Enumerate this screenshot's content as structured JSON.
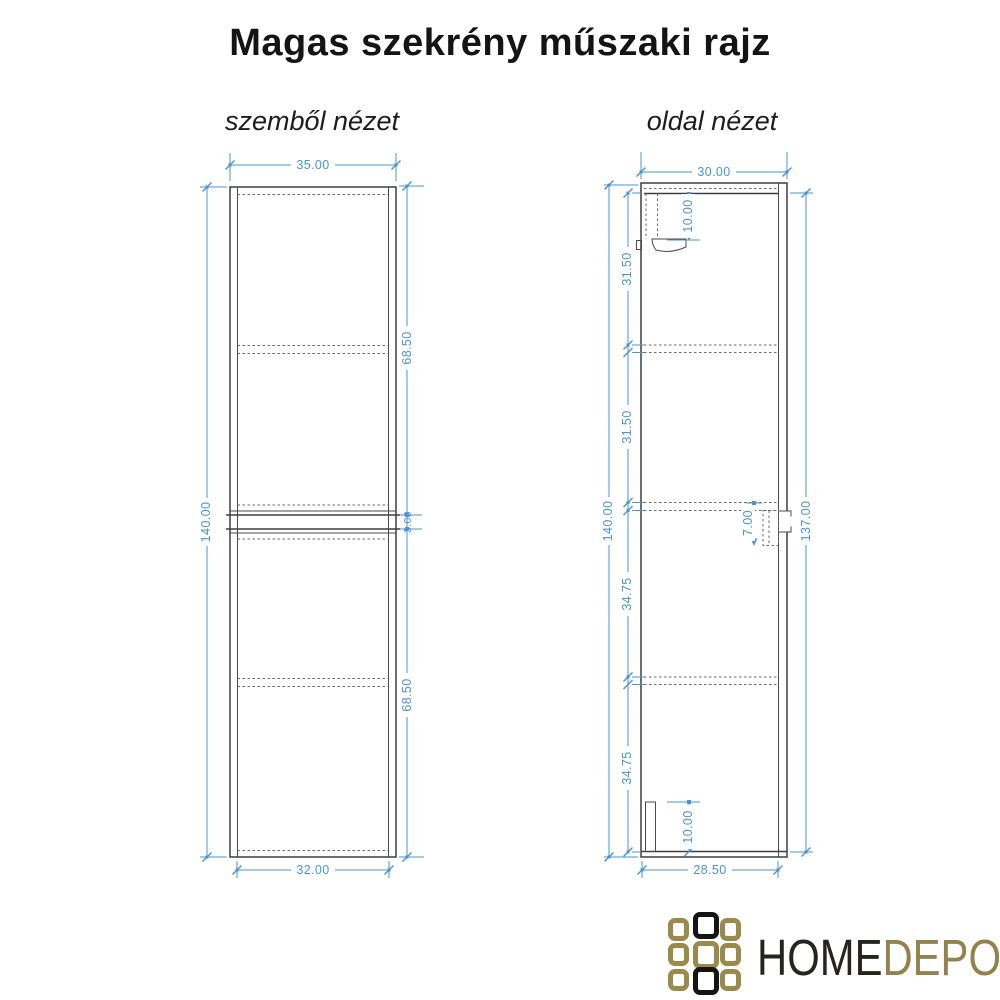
{
  "title": "Magas szekrény műszaki rajz",
  "front_view": {
    "label": "szemből nézet",
    "dims": {
      "top_width": "35.00",
      "height": "140.00",
      "upper_section": "68.50",
      "gap": "3.00",
      "lower_section": "68.50",
      "bottom_width": "32.00"
    }
  },
  "side_view": {
    "label": "oldal nézet",
    "dims": {
      "top_width": "30.00",
      "height": "140.00",
      "segment_1": "31.50",
      "segment_2": "31.50",
      "segment_3": "34.75",
      "segment_4": "34.75",
      "front_height": "137.00",
      "top_bracket": "10.00",
      "mid_bracket": "7.00",
      "bottom_bracket": "10.00",
      "bottom_width": "28.50"
    }
  },
  "logo": {
    "word_home": "HOME",
    "word_depo": "DEPO"
  },
  "colors": {
    "dimension_blue": "#4a94d4",
    "line_dark": "#3e3e3e",
    "logo_gold": "#9a8a4c",
    "logo_black": "#151515"
  }
}
